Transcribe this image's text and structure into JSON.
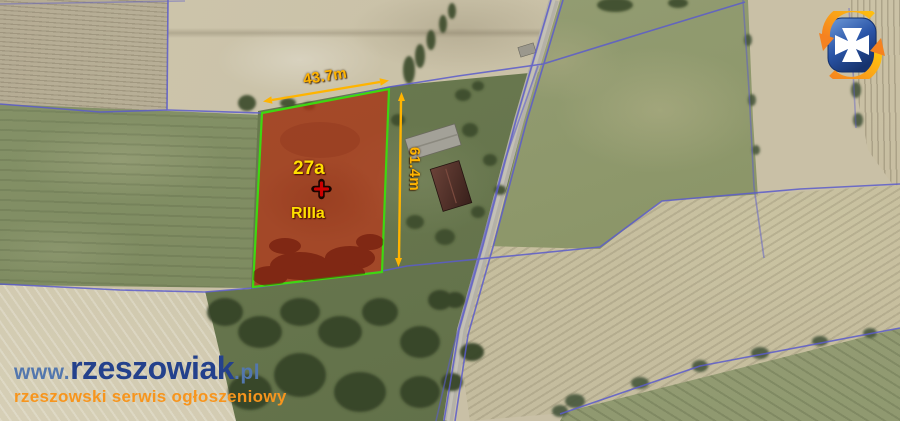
{
  "overlay": {
    "width_label": "43.7m",
    "height_label": "61.4m",
    "area_label": "27a",
    "soil_class_label": "RIIIa",
    "accent_color": "#ffb400",
    "label_color": "#ffdf00",
    "parcel_fill": "#cf280e",
    "parcel_border": "#3fd711",
    "marker_color": "#cf0000",
    "marker_icon": "plus-cross-marker"
  },
  "map": {
    "type": "aerial-photo",
    "boundary_line_color": "#5b5ccc",
    "road_color": "#b4b1a7"
  },
  "watermark": {
    "url_prefix": "www.",
    "url_name": "rzeszowiak",
    "url_suffix": ".pl",
    "tagline": "rzeszowski serwis ogłoszeniowy",
    "name_color": "#24418c",
    "prefix_color": "#5377ae",
    "tagline_color": "#f7951d"
  },
  "logo": {
    "icon": "rzeszowiak-crest-logo",
    "cross_icon": "maltese-cross",
    "shield_color_top": "#6f9bd8",
    "shield_color_bottom": "#17336e",
    "arrow_color": "#f58220"
  }
}
